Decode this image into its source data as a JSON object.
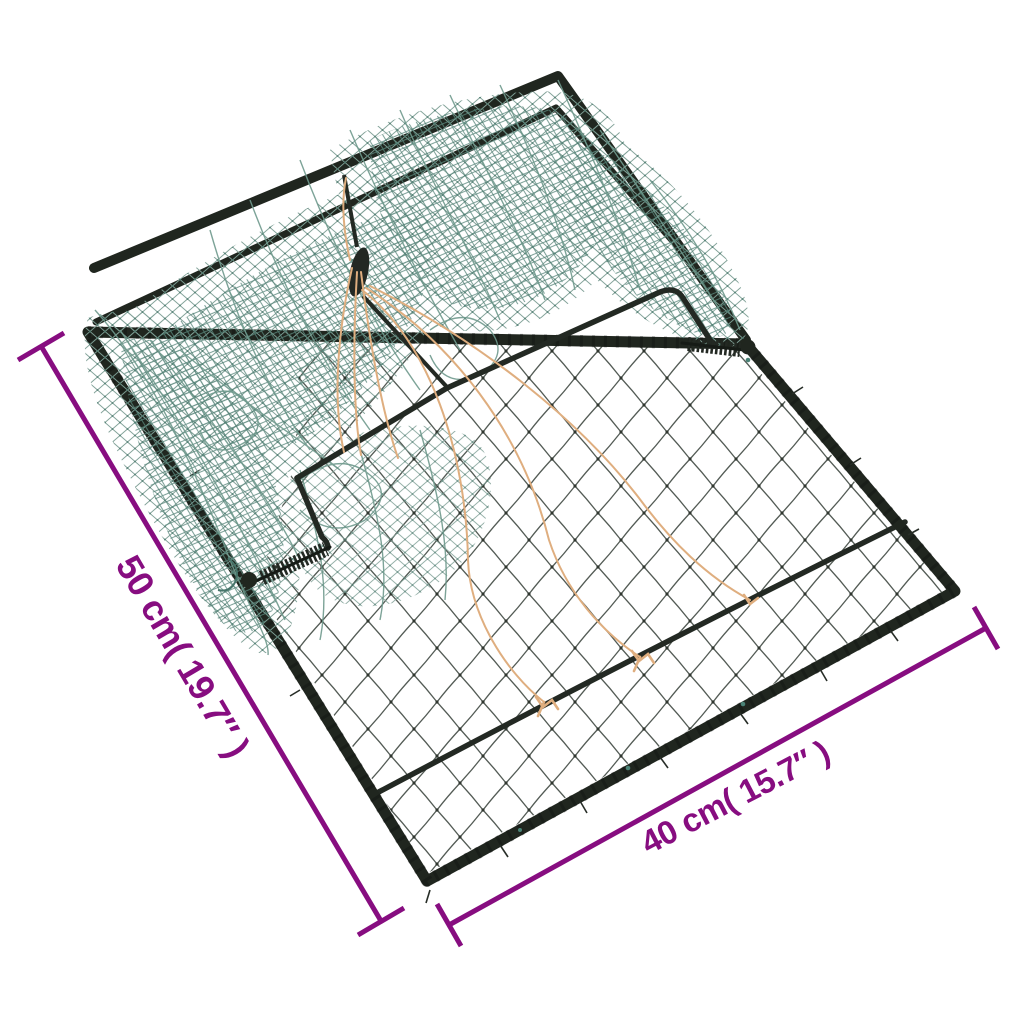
{
  "scene": {
    "background": "#ffffff"
  },
  "annotations": {
    "color": "#870d80",
    "side": {
      "label": "50 cm( 19.7″ )"
    },
    "bottom": {
      "label": "40 cm( 15.7″ )"
    }
  },
  "trap": {
    "frame_color": "#20261f",
    "hardware_color": "#232923",
    "fine_net_color": "#535b55",
    "fine_net_knot_color": "#2f362f",
    "green_net_color": "#7fa096",
    "green_net_knot_color": "#4a7a6e",
    "green_net_dense_color": "#5b887d",
    "green_strand_color": "#6f9a8d",
    "string_color": "#dfae7f"
  }
}
